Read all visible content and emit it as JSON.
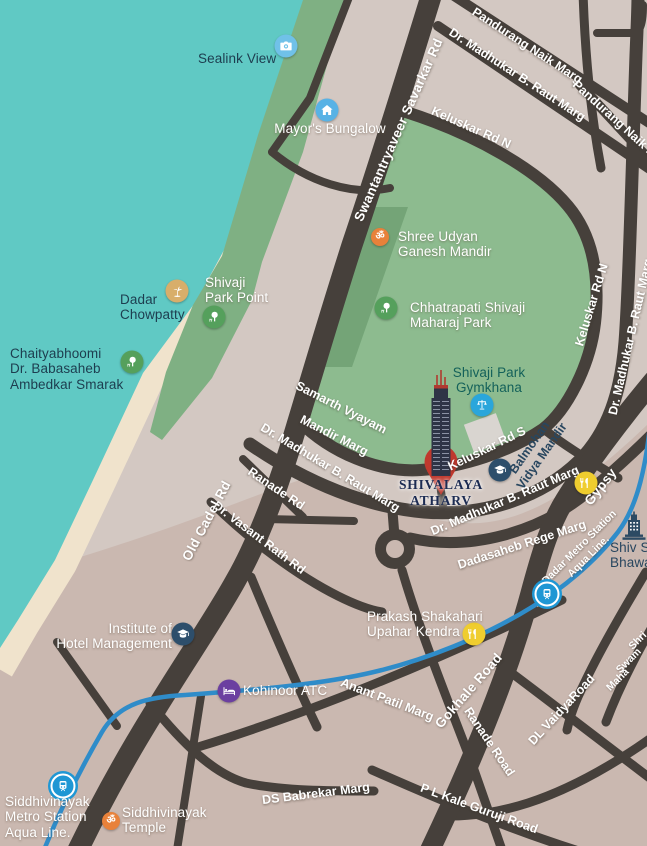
{
  "pois": {
    "sealink_view": {
      "label": "Sealink View",
      "icon": "camera-icon"
    },
    "mayors_bungalow": {
      "label": "Mayor's Bungalow",
      "icon": "house-icon"
    },
    "shree_udyan": {
      "l1": "Shree Udyan",
      "l2": "Ganesh Mandir",
      "icon": "om-icon"
    },
    "shivaji_park": {
      "l1": "Chhatrapati Shivaji",
      "l2": "Maharaj Park",
      "icon": "tree-icon"
    },
    "park_point": {
      "l1": "Shivaji",
      "l2": "Park Point",
      "icon": "tree-icon"
    },
    "chowpatty": {
      "l1": "Dadar",
      "l2": "Chowpatty",
      "icon": "palm-icon"
    },
    "chaityabhoomi": {
      "l1": "Chaityabhoomi",
      "l2": "Dr. Babasaheb",
      "l3": "Ambedkar Smarak",
      "icon": "tree-icon"
    },
    "gymkhana": {
      "l1": "Shivaji Park",
      "l2": "Gymkhana",
      "icon": "scales-icon"
    },
    "balmohan": {
      "l1": "Balmohan",
      "l2": "Vidya Mandir",
      "icon": "graduation-cap-icon"
    },
    "gypsy": {
      "label": "Gypsy",
      "icon": "restaurant-icon"
    },
    "shiv_sena": {
      "l1": "Shiv Sena",
      "l2": "Bhawan",
      "icon": "building-icon"
    },
    "institute": {
      "l1": "Institute of",
      "l2": "Hotel Management",
      "icon": "graduation-cap-icon"
    },
    "kohinoor": {
      "label": "Kohinoor ATC",
      "icon": "bed-icon"
    },
    "prakash": {
      "l1": "Prakash Shakahari",
      "l2": "Upahar Kendra",
      "icon": "restaurant-icon"
    },
    "dadar_metro": {
      "l1": "Dadar Metro Station",
      "l2": "Aqua Line.",
      "icon": "metro-train-icon"
    },
    "siddhi_metro": {
      "l1": "Siddhivinayak",
      "l2": "Metro Station",
      "l3": "Aqua Line.",
      "icon": "metro-train-icon"
    },
    "siddhi_temple": {
      "l1": "Siddhivinayak",
      "l2": "Temple",
      "icon": "om-icon"
    }
  },
  "landmark": {
    "l1": "SHIVALAYA",
    "l2": "ATHARV",
    "icon": "tower-pin-icon"
  },
  "roads": {
    "savarkar": "Swantantryaveer Savarkar Rd",
    "pandurang": "Pandurang Naik Marg",
    "raut": "Dr. Madhukar B. Raut Marg",
    "keluskar_n": "Keluskar Rd N",
    "keluskar_s": "Keluskar Rd S",
    "samarth_l1": "Samarth Vyayam",
    "samarth_l2": "Mandir Marg",
    "ranade_rd": "Ranade Rd",
    "ranade_road": "Ranade Road",
    "vasant": "Dr. Vasant Rath Rd",
    "rege": "Dadasaheb Rege Marg",
    "old_cadel": "Old Cadel Rd",
    "anant": "Anant Patil Marg",
    "gokhale": "Gokhale Road",
    "dl_vaidya": "DL VaidyaRoad",
    "ds_babrekar": "DS Babrekar Marg",
    "pl_kale": "P L Kale Guruji Road",
    "shri_l1": "Shri",
    "shri_l2": "Swam",
    "shri_l3": "Maha"
  },
  "colors": {
    "water": "#60c9c4",
    "sand": "#f0e3cc",
    "land": "#d3c8c2",
    "land_south": "#cab8b0",
    "park": "#8dbb8f",
    "park_dark": "#74a477",
    "coastal_green": "#7fb083",
    "road": "#46403b",
    "metro_line": "#2f8cc9",
    "pin_red": "#c0392e",
    "icon_blue_light": "#70c1e8",
    "icon_blue": "#58b2e5",
    "icon_orange": "#e8813a",
    "icon_green": "#55a05c",
    "icon_tan": "#d8ae6a",
    "icon_cyan": "#2aa6db",
    "icon_navy": "#2d4e6b",
    "icon_yellow": "#efcd2f",
    "icon_purple": "#6b3fa0",
    "icon_metro": "#1f97d4",
    "label_dark": "#1d3d4f"
  }
}
